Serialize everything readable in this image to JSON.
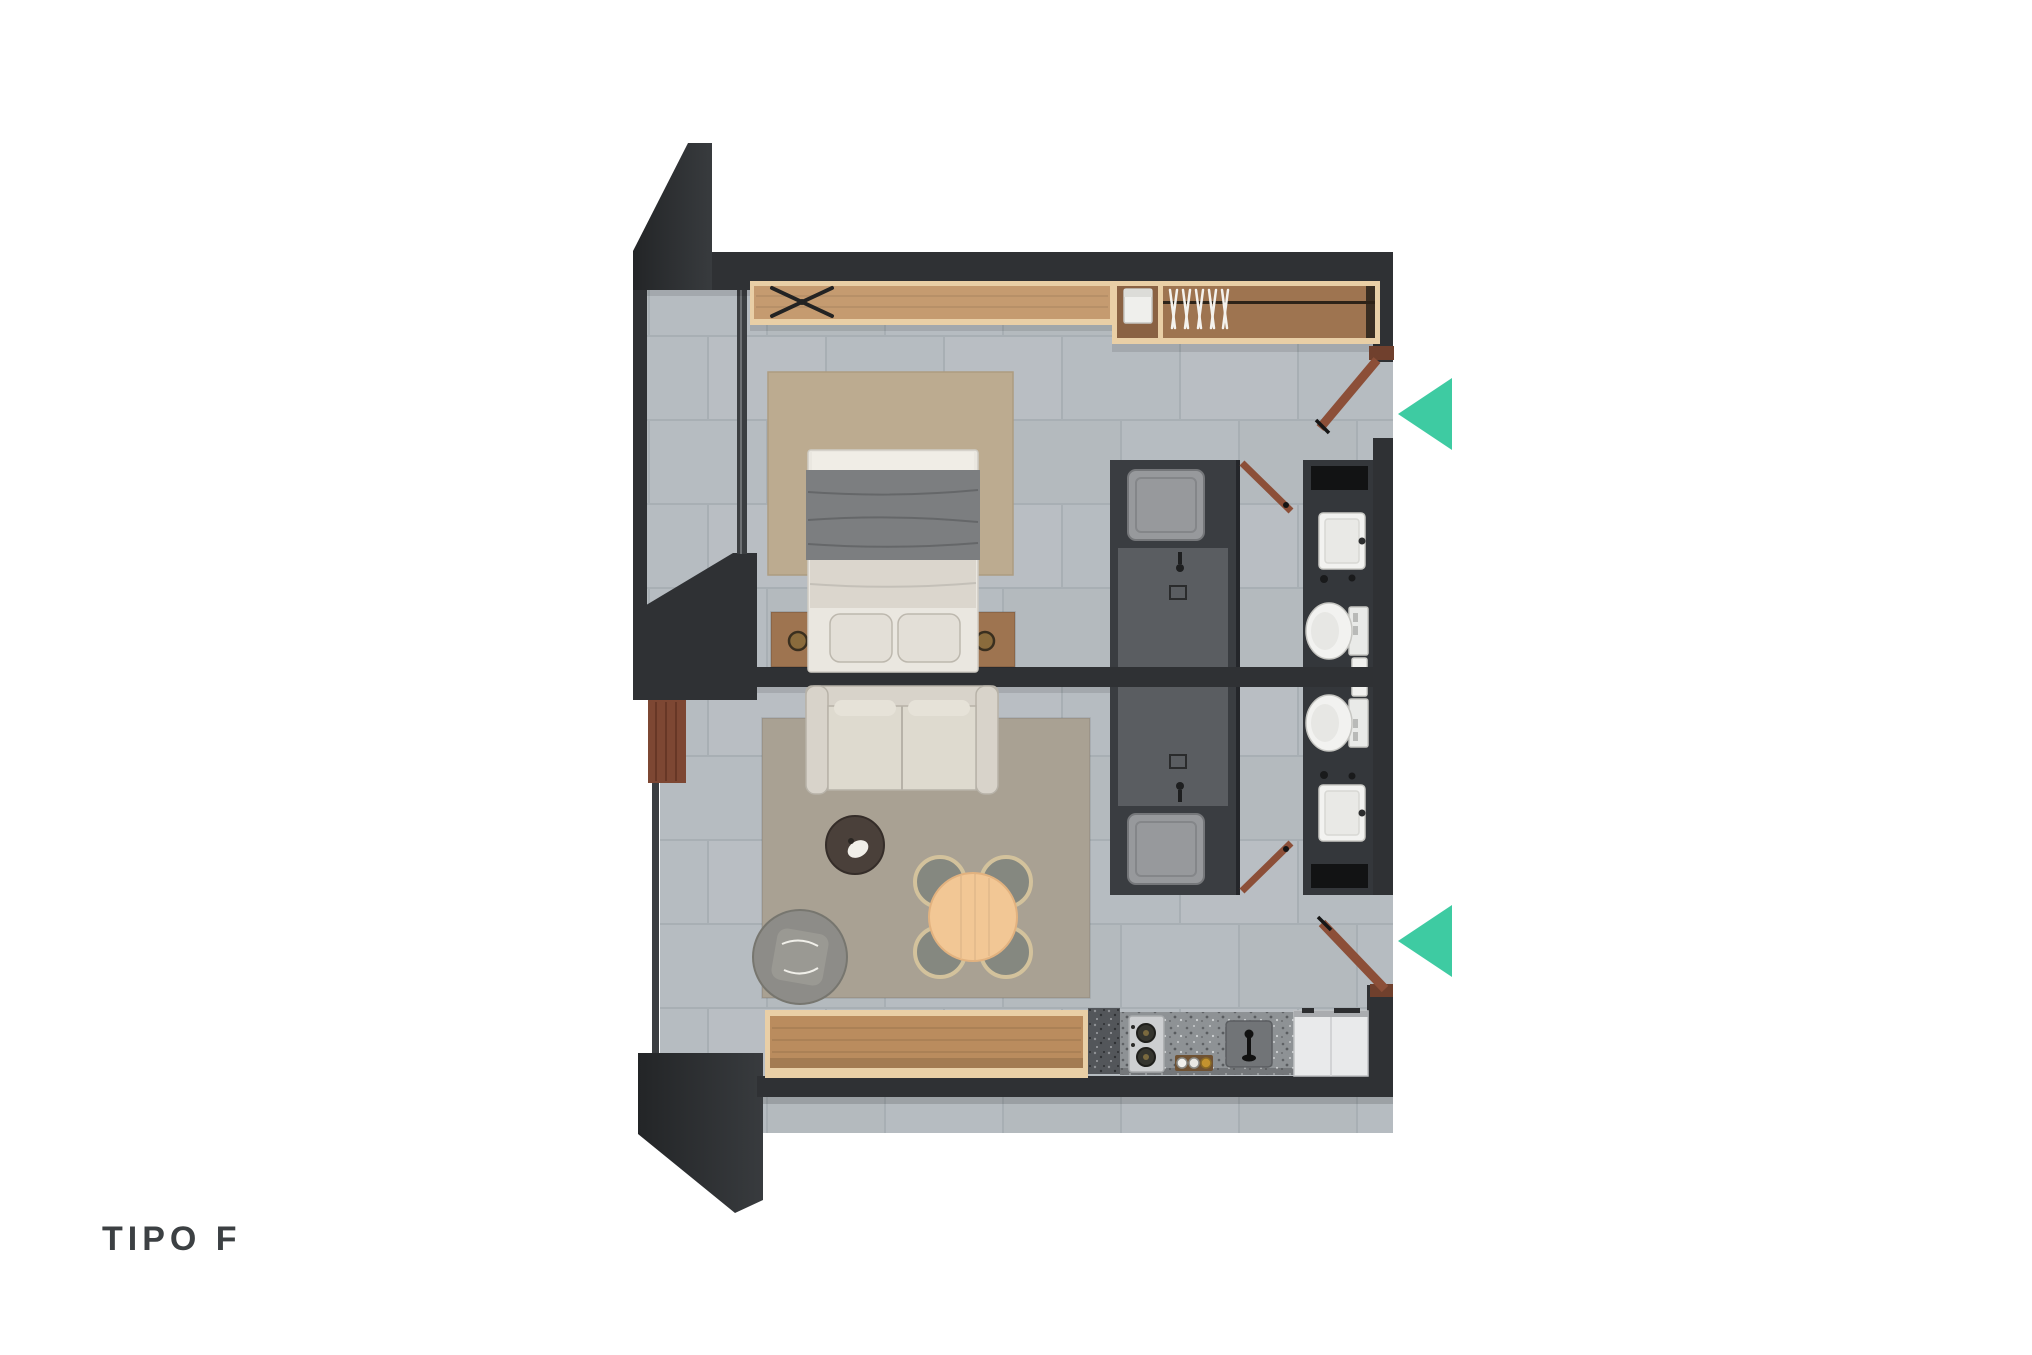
{
  "plan": {
    "title": "TIPO F"
  },
  "entry_indicators": {
    "count": 2,
    "direction": "left",
    "color": "#3ecba2"
  },
  "palette": {
    "wall": "#2f3134",
    "wall_dark": "#232527",
    "floor_tile": "#b6bcc1",
    "tile_line": "#a8afb4",
    "wood_light": "#c59b70",
    "wood_trim": "#e9cfa6",
    "wood_mid": "#9e7450",
    "wood_dark": "#7d4733",
    "door_wood": "#8c4f38",
    "linen": "#e3dfd7",
    "blanket_gray": "#7c7e80",
    "rug_bedroom": "#bcab90",
    "rug_living": "#a9a193",
    "sofa": "#d8d3ca",
    "armchair": "#8d8c88",
    "table_wood": "#f2c795",
    "chair_gray": "#858880",
    "cabinet_dark": "#3a3d41",
    "cabinet_mid": "#5a5d61",
    "fixture_white": "#f2f2f0",
    "granite": "#8e9295",
    "steel": "#cdcfd1",
    "fridge_white": "#e9eaeb",
    "accent": "#3ecba2",
    "label_text": "#3c4043"
  }
}
